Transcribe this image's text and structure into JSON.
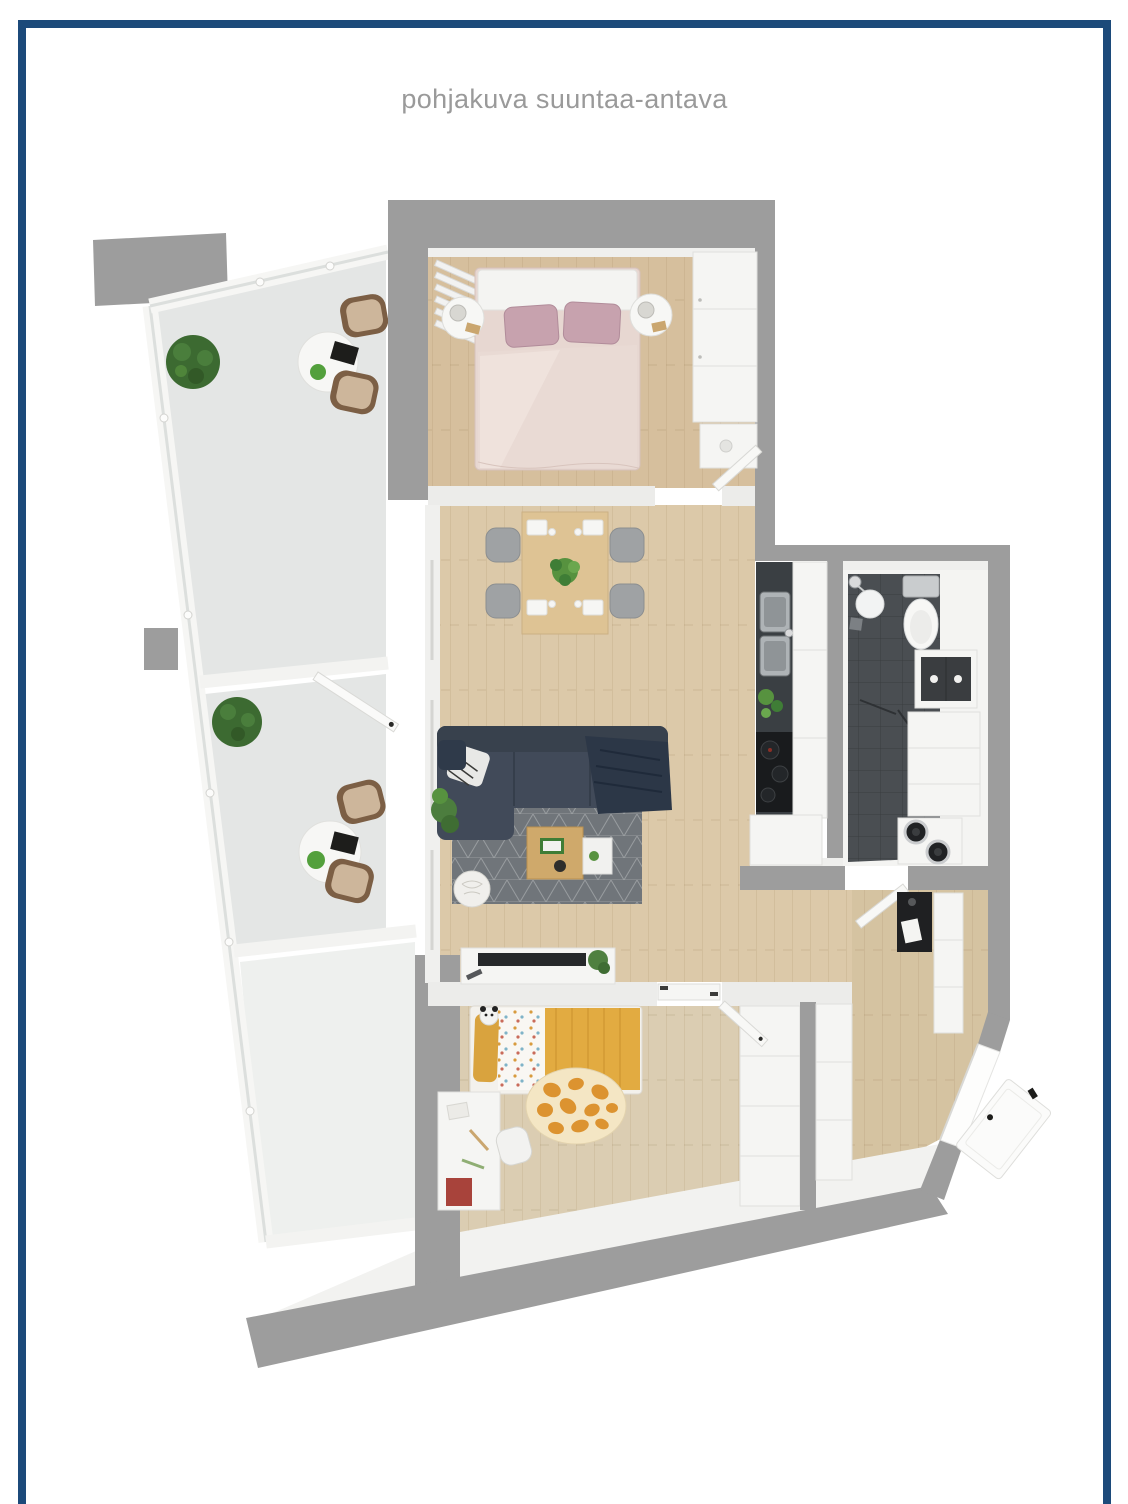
{
  "header": {
    "title": "pohjakuva suuntaa-antava"
  },
  "theme": {
    "background": "#ffffff",
    "frame_color": "#1c4a7a",
    "title_color": "#9a9a9a",
    "wall_color": "#9d9d9d",
    "inner_wall_color": "#ececea",
    "balcony_floor": "#e4e6e5",
    "neighbor_floor": "#eef0ee",
    "wood_bedroom": "#d6bf9d",
    "wood_living": "#dcc9a9",
    "wood_kids": "#dbcdb2",
    "wood_hall": "#d5c3a1",
    "bathroom_tile": "#4a4e52",
    "kitchen_counter": "#3a3f43",
    "sofa_color": "#414a59",
    "rug_color": "#70757a",
    "dining_table_wood": "#dec394",
    "coffee_table_wood": "#cfa96b",
    "accent_yellow": "#e2ab41",
    "accent_pink": "#c7a2ae",
    "giraffe_rug_base": "#f4e6c4",
    "giraffe_rug_spot": "#dc9330",
    "plant_green": "#4f8040",
    "rattan_frame": "#7c5f45",
    "rattan_cushion": "#cdb69b"
  },
  "floor_plan": {
    "type": "3d_top_down_apartment_rendering",
    "rooms": [
      {
        "id": "balcony-upper",
        "furniture": [
          "shrub-planter",
          "round-bistro-table",
          "rattan-chair",
          "rattan-chair",
          "magazine"
        ]
      },
      {
        "id": "balcony-lower",
        "furniture": [
          "shrub-planter",
          "round-bistro-table",
          "rattan-chair",
          "rattan-chair",
          "glass-partition-door"
        ]
      },
      {
        "id": "bedroom",
        "furniture": [
          "double-bed",
          "pink-pillows",
          "nightstand",
          "nightstand",
          "table-lamps",
          "wardrobe",
          "vanity-desk",
          "window-curtains",
          "door-ajar"
        ]
      },
      {
        "id": "living-dining",
        "furniture": [
          "dining-table",
          "dining-chair",
          "dining-chair",
          "dining-chair",
          "dining-chair",
          "plant-centerpiece",
          "corner-sofa",
          "throw-pillows",
          "area-rug",
          "coffee-table",
          "side-pouf",
          "tv-sideboard",
          "tv",
          "floor-plant"
        ]
      },
      {
        "id": "kitchen",
        "furniture": [
          "double-sink",
          "faucet",
          "cooktop",
          "tall-cabinets",
          "base-cabinet",
          "herb-plants"
        ]
      },
      {
        "id": "bathroom",
        "furniture": [
          "shower-head",
          "shower-dish",
          "toilet",
          "mirror-vanity",
          "tall-cabinet",
          "washer-dryer-stack",
          "door-ajar"
        ]
      },
      {
        "id": "kids-room",
        "furniture": [
          "single-bed",
          "yellow-blanket",
          "plush-panda",
          "giraffe-print-rug",
          "desk",
          "desk-chair",
          "red-drawer",
          "wardrobe",
          "door-ajar"
        ]
      },
      {
        "id": "hallway",
        "furniture": [
          "black-wall-shelf",
          "sideboard",
          "coat-wardrobe",
          "entrance-door-ajar"
        ]
      }
    ]
  }
}
